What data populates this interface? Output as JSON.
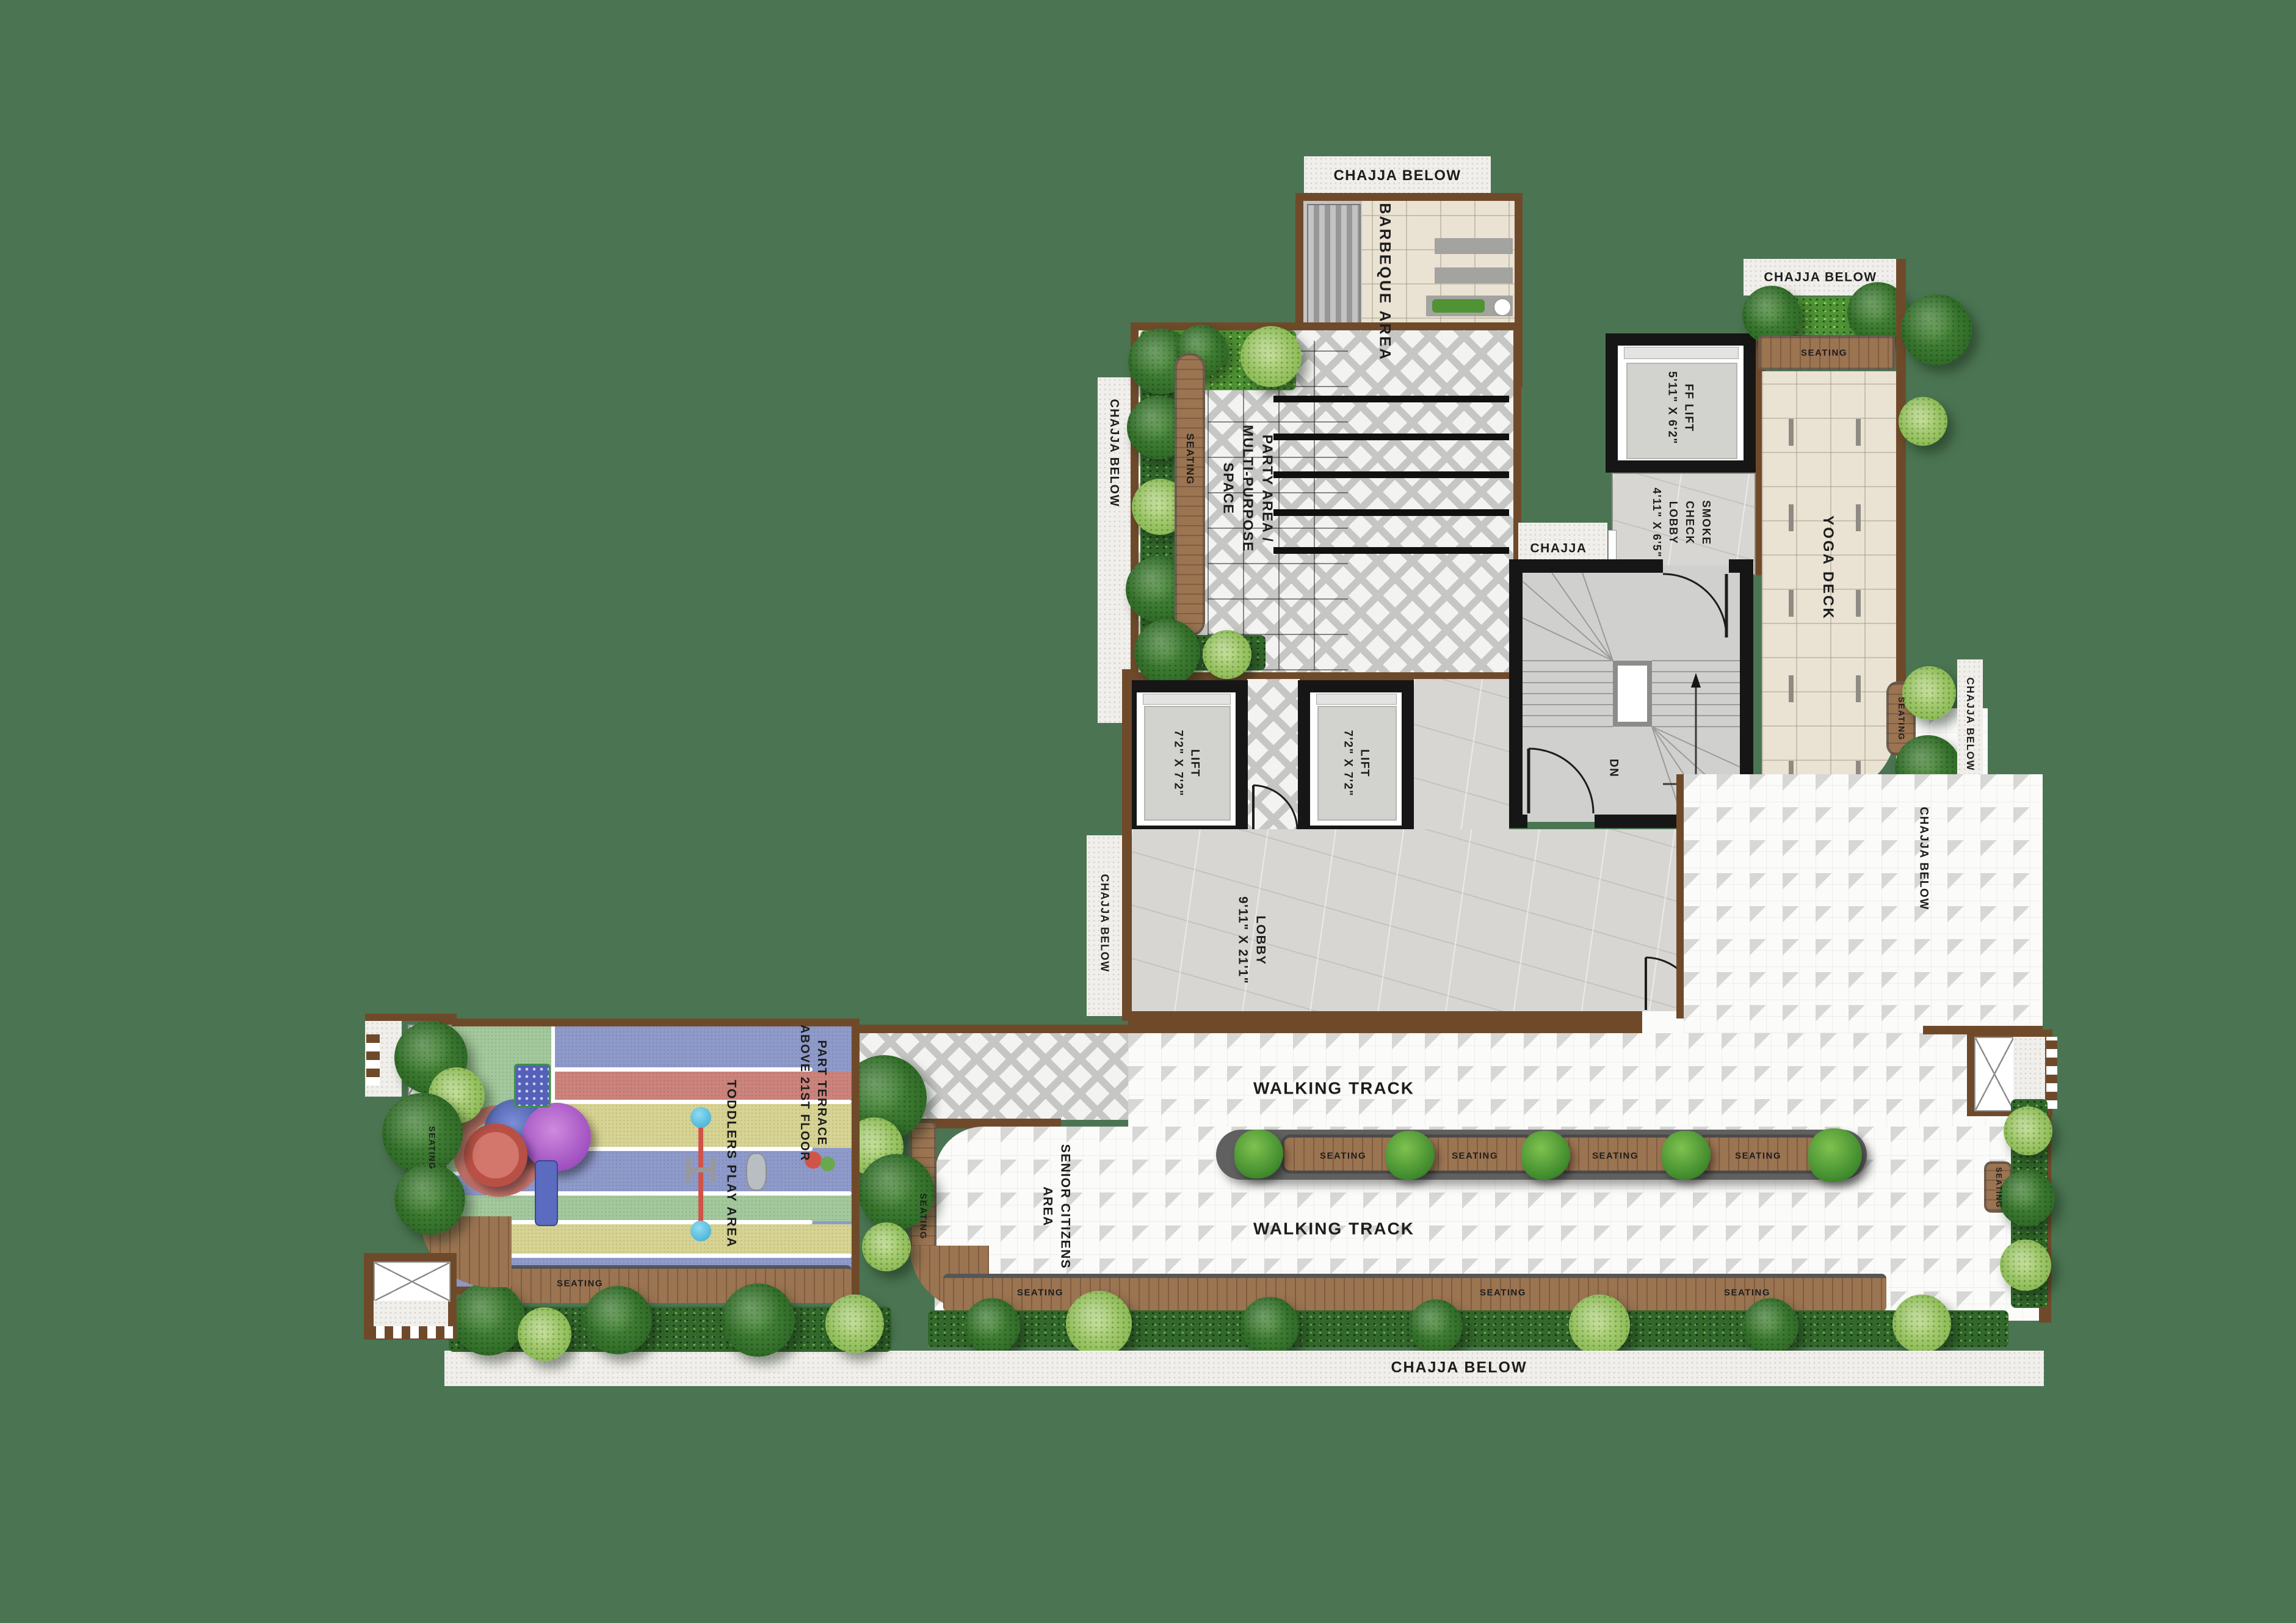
{
  "colors": {
    "background_green": "#4b7552",
    "wall_brown": "#6f4a2a",
    "wall_black": "#161616",
    "bench_wood": "#9b7452",
    "hedge_green": "#33682c",
    "chajja_white": "#f1efeb"
  },
  "labels": {
    "chajja_below": "CHAJJA BELOW",
    "chajja": "CHAJJA",
    "seating": "SEATING",
    "dn": "DN",
    "walking_track": "WALKING TRACK",
    "barbeque_area": "BARBEQUE AREA",
    "party_area": "PARTY AREA /\nMULTI-PURPOSE\nSPACE",
    "ff_lift": "FF LIFT\n5'11\" X 6'2\"",
    "smoke_check_lobby": "SMOKE\nCHECK\nLOBBY\n4'11\" X 6'5\"",
    "lift": "LIFT\n7'2\" X 7'2\"",
    "lobby": "LOBBY\n9'11\" X 21'1\"",
    "yoga_deck": "YOGA DECK",
    "senior_citizens_area": "SENIOR CITIZENS\nAREA",
    "toddlers_play_area": "TODDLERS PLAY AREA",
    "part_terrace": "PART TERRACE\nABOVE 21ST FLOOR"
  }
}
